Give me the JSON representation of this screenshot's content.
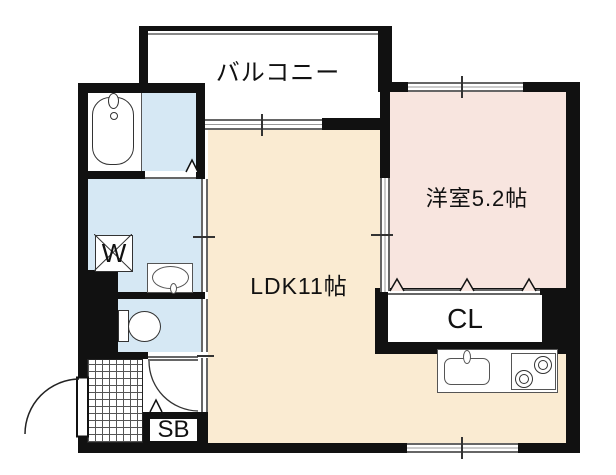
{
  "floorplan": {
    "balcony": {
      "label": "バルコニー"
    },
    "western_room": {
      "label": "洋室5.2帖"
    },
    "ldk": {
      "label": "LDK11帖"
    },
    "closet": {
      "label": "CL"
    },
    "shoe_box": {
      "label": "SB"
    },
    "washing_machine": {
      "label": "W"
    },
    "colors": {
      "wall": "#111111",
      "ldk_floor": "#faebd2",
      "western_room_floor": "#f8e5df",
      "wet_area_floor": "#d6e8f4",
      "window_line": "#666666",
      "fixture_line": "#333333"
    }
  }
}
